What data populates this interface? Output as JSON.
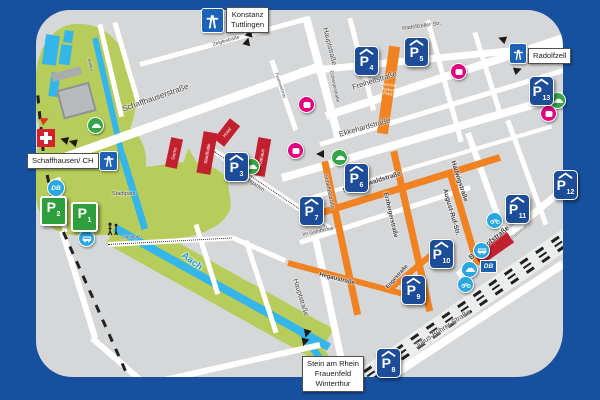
{
  "colors": {
    "frame_blue": "#17509f",
    "map_gray": "#d6d7d8",
    "street_orange": "#f08221",
    "park_green": "#b7cc5a",
    "water_blue": "#35b6ea",
    "garage_blue": "#1d4c99",
    "lot_green": "#2f9e3d",
    "poi_pink": "#e5007d",
    "transit_blue": "#29a7e0",
    "building_red": "#c1202f"
  },
  "signs": {
    "konstanz": {
      "lines": [
        "Konstanz",
        "Tuttlingen"
      ]
    },
    "radolfzell": {
      "label": "Radolfzell"
    },
    "schaffhausen": {
      "label": "Schaffhausen/ CH"
    },
    "stein": {
      "lines": [
        "Stein am Rhein",
        "Frauenfeld",
        "Winterthur"
      ]
    }
  },
  "parking": {
    "p_letter": "P",
    "garages": [
      {
        "number": "3"
      },
      {
        "number": "4"
      },
      {
        "number": "5"
      },
      {
        "number": "6"
      },
      {
        "number": "7"
      },
      {
        "number": "8"
      },
      {
        "number": "9"
      },
      {
        "number": "10"
      },
      {
        "number": "11"
      },
      {
        "number": "12"
      },
      {
        "number": "13"
      }
    ],
    "lots": [
      {
        "number": "2"
      },
      {
        "number": "1"
      }
    ]
  },
  "streets": {
    "schaffhauser": "Schaffhauserstraße",
    "haupt": "Hauptstraße",
    "freiheit": "Freiheitstraße",
    "ekkehard": "Ekkehardstraße",
    "schwarzwald": "Schwarzwaldstraße",
    "erzberger": "Erzbergerstraße",
    "scheffel": "Scheffelstraße",
    "august_ruf": "August-Ruf-Str.",
    "hadwig": "Hadwigstraße",
    "hegau": "Hegaustraße",
    "enge": "Engestraße",
    "im_gambrinus": "Im Gambrinus",
    "hohgarten": "Hohgarten",
    "bahnhofstr": "Bahnhofstraße",
    "julius": "Julius-Bührer-Straße",
    "radolfzeller": "Radolfzeller Str.",
    "zelgle": "Zelglestraße",
    "feuerwehr": "Feuerwehrstr.",
    "bastei": "Bastei",
    "oehningen": "Öhningen"
  },
  "places": {
    "gems": "Gems",
    "stadthalle": "Stadthalle",
    "hotel": "Hotel",
    "rathaus": "Rathaus",
    "bahnhof": "Bahnhof",
    "stadtpark": "Stadtpark",
    "aach": "Aach",
    "hwp": [
      "Heinrich-",
      "Weber-",
      "Platz"
    ]
  },
  "logos": {
    "db": "DB"
  }
}
